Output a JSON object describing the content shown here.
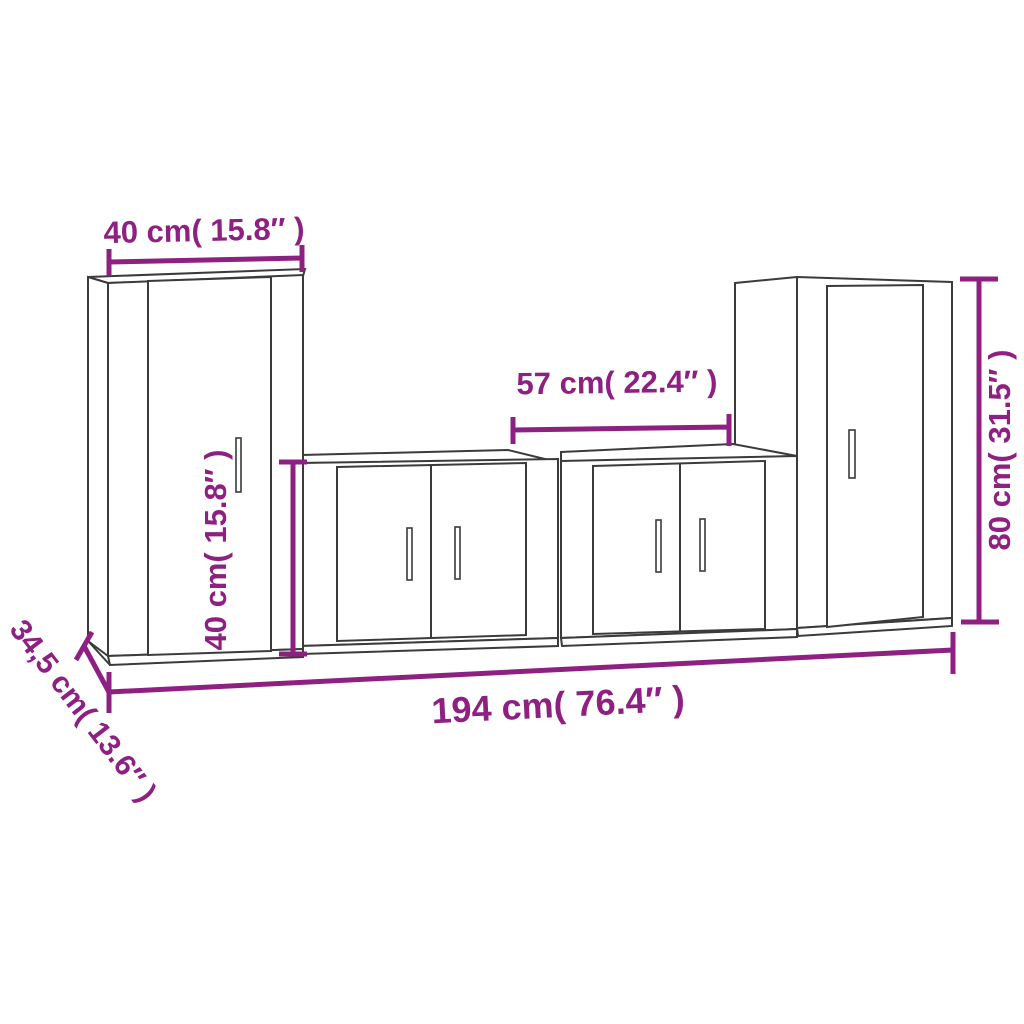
{
  "colors": {
    "accent": "#8E2082",
    "outline": "#3b3b3b",
    "background": "#ffffff",
    "cabinet_fill": "#ffffff"
  },
  "diagram": {
    "measurements": {
      "top_width": "40 cm( 15.8″ )",
      "middle_width": "57 cm( 22.4″ )",
      "left_height": "40 cm( 15.8″ )",
      "right_height": "80 cm( 31.5″ )",
      "total_width": "194 cm( 76.4″ )",
      "depth": "34,5 cm( 13.6″ )"
    }
  }
}
